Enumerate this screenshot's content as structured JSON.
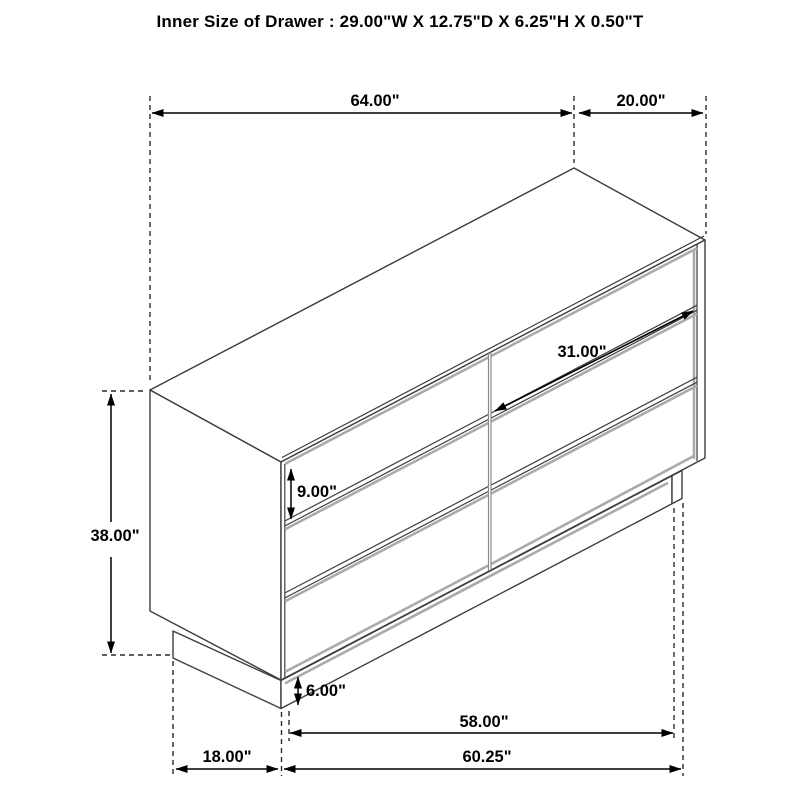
{
  "title": "Inner Size of Drawer : 29.00\"W X 12.75\"D X 6.25\"H X 0.50\"T",
  "dimensions": {
    "top_width": "64.00\"",
    "top_depth": "20.00\"",
    "drawer_width": "31.00\"",
    "drawer_face_height": "9.00\"",
    "overall_height": "38.00\"",
    "base_height": "6.00\"",
    "base_width": "58.00\"",
    "floor_width": "60.25\"",
    "base_depth": "18.00\""
  },
  "colors": {
    "line": "#3d3d3d",
    "dimension": "#000000",
    "shadow_gray": "#aaaaaa",
    "background": "#ffffff"
  }
}
